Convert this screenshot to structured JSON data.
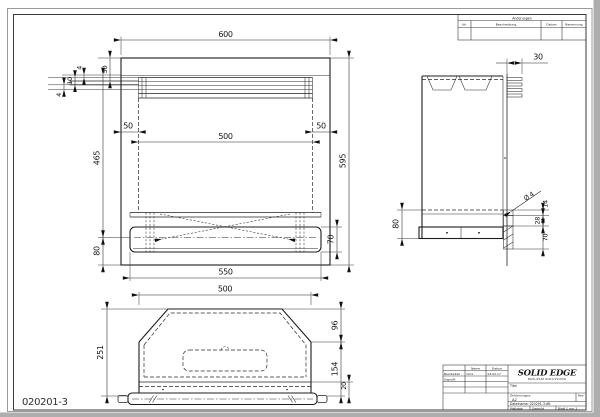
{
  "sheet": {
    "drawing_number": "020201-3"
  },
  "revisions": {
    "title": "Änderungen",
    "col_nr": "Nr.",
    "col_desc": "Beschreibung",
    "col_date": "Datum",
    "col_name": "Benennung"
  },
  "title_block": {
    "brand": "SOLID EDGE",
    "brand_sub": "EDS-PLM SOLUTIONS",
    "col_name": "Name",
    "col_date": "Datum",
    "row1_label": "Bearbeitet",
    "row1_name": "hme",
    "row1_date": "02.02.17",
    "row2_label": "Geprüft",
    "title_label": "Titel",
    "drawing_no_label": "Zeichnungsnr.",
    "size_value": "A2",
    "rev_label": "Rev",
    "filename": "Dateiname: 020201-3.dft",
    "scale_label": "Maßstab",
    "weight_label": "Gewicht",
    "sheet_label": "Blatt 1 von 1"
  },
  "front_view": {
    "dims": {
      "width": "600",
      "top_band": "50",
      "lip_a": "4",
      "lip_b": "10",
      "lip_c": "4",
      "inset_left": "50",
      "opening": "500",
      "inset_right": "50",
      "height_left": "465",
      "height_right": "595",
      "base": "80",
      "bar": "70",
      "base_width": "550"
    }
  },
  "bottom_view": {
    "dims": {
      "width": "500",
      "depth": "251",
      "chamfer": "96",
      "lower": "154",
      "plate": "20"
    }
  },
  "side_view": {
    "dims": {
      "fin": "30",
      "base": "80",
      "hole": "Ø 4",
      "p1": "14",
      "p2": "28",
      "p3": "70"
    }
  }
}
